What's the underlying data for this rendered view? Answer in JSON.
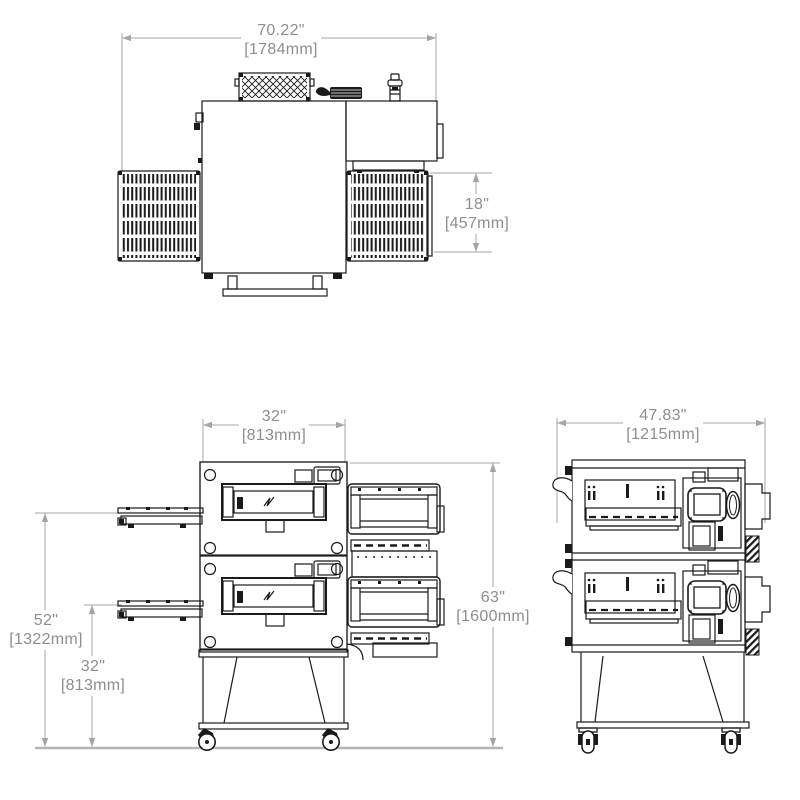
{
  "colors": {
    "line": "#1a1a1a",
    "dimension_line": "#a5a5a5",
    "dimension_text": "#8e8e8e",
    "ground_line": "#b5b5b5",
    "background": "#ffffff"
  },
  "top_view": {
    "width": {
      "inches": "70.22\"",
      "mm": "[1784mm]"
    },
    "conveyor_depth": {
      "inches": "18\"",
      "mm": "[457mm]"
    }
  },
  "front_view": {
    "body_width": {
      "inches": "32\"",
      "mm": "[813mm]"
    },
    "upper_belt_height": {
      "inches": "52\"",
      "mm": "[1322mm]"
    },
    "lower_belt_height": {
      "inches": "32\"",
      "mm": "[813mm]"
    },
    "overall_height": {
      "inches": "63\"",
      "mm": "[1600mm]"
    }
  },
  "side_view": {
    "depth": {
      "inches": "47.83\"",
      "mm": "[1215mm]"
    }
  }
}
